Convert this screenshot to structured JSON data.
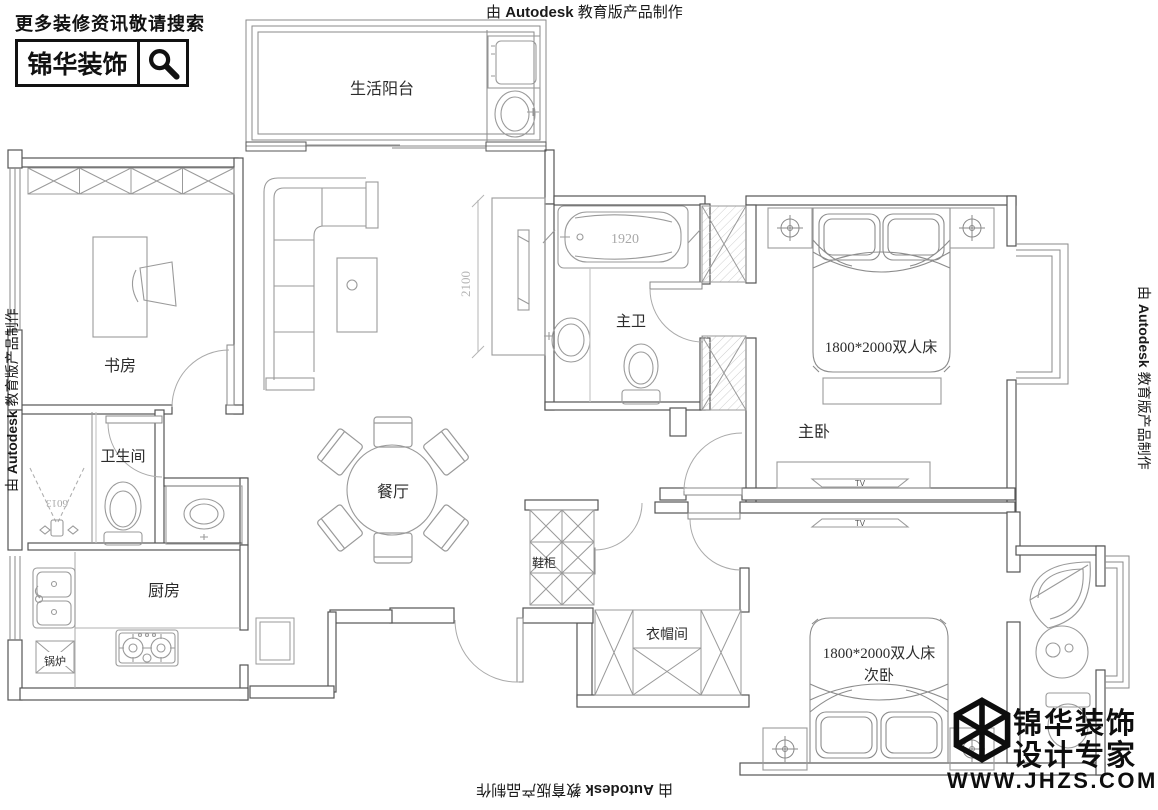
{
  "watermark": {
    "prefix": "由",
    "brand": "Autodesk",
    "suffix": "教育版产品制作"
  },
  "header": {
    "search_hint": "更多装修资讯敬请搜索",
    "brand_box": "锦华装饰"
  },
  "footer_logo": {
    "line1": "锦华装饰",
    "line2": "设计专家",
    "website": "WWW.JHZS.COM"
  },
  "rooms": {
    "balcony": "生活阳台",
    "study": "书房",
    "master_bath": "主卫",
    "master_bedroom": "主卧",
    "bathroom": "卫生间",
    "dining": "餐厅",
    "kitchen": "厨房",
    "shoe_cabinet": "鞋柜",
    "closet": "衣帽间",
    "secondary_bedroom": "次卧"
  },
  "labels": {
    "master_bed": "1800*2000双人床",
    "secondary_bed": "1800*2000双人床",
    "boiler": "锅炉",
    "tub_size": "1920",
    "living_depth": "2100",
    "shower_code": "6013",
    "tv": "TV"
  }
}
